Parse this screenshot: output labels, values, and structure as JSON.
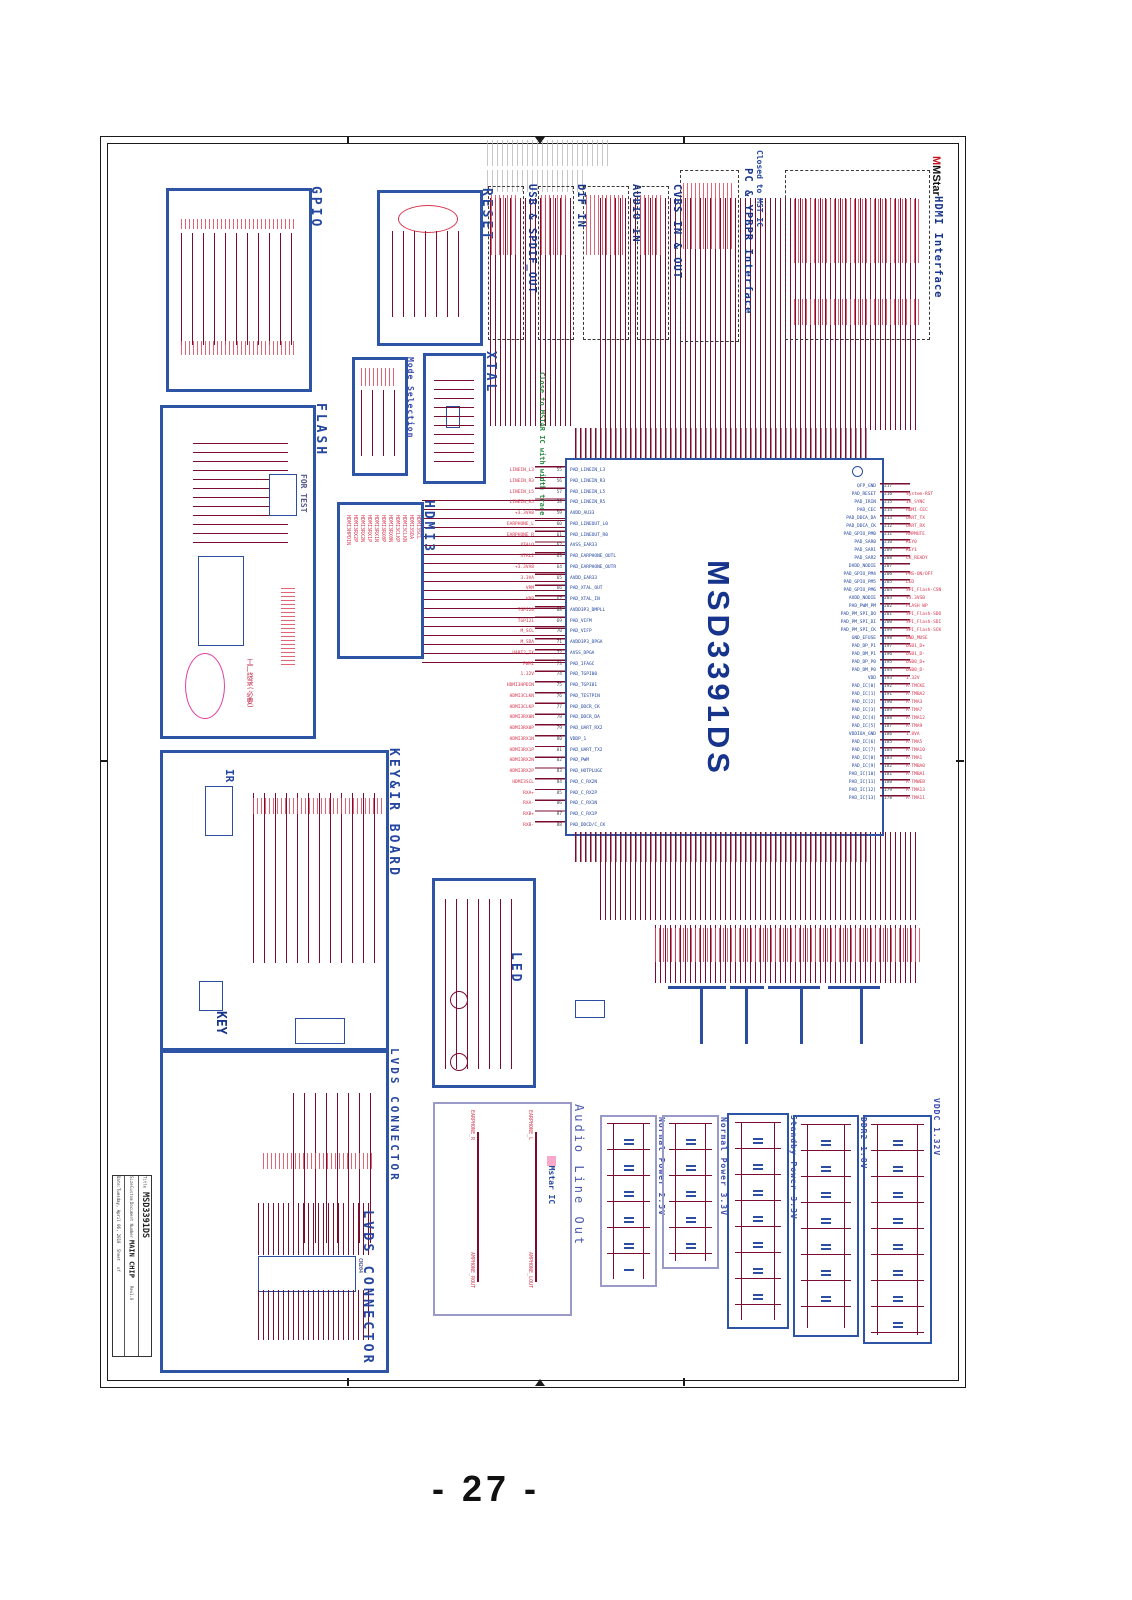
{
  "page": {
    "number": "- 27 -"
  },
  "colors": {
    "block_border": "#2e55a5",
    "soft_border": "#9a9ac8",
    "label_blue": "#2446a0",
    "wire_maroon": "#7a0c2e",
    "net_red": "#d9344e",
    "note_green": "#2e8b45",
    "highlight_magenta": "#e040a0"
  },
  "blocks": {
    "gpio": {
      "label": "GPIO"
    },
    "flash": {
      "label": "FLASH",
      "for_test": "FOR TEST",
      "factory_note": "工厂烧录(必要)"
    },
    "reset": {
      "label": "RESET"
    },
    "mode_selection": {
      "label": "Mode Selection"
    },
    "xtal": {
      "label": "XTAL",
      "note": "Close to MSTAR IC with width trace"
    },
    "hdmi3": {
      "label": "HDMI3",
      "signals": [
        "HDMI3HPDIN",
        "HDMI3RX2P",
        "HDMI3RX2N",
        "HDMI3RX1P",
        "HDMI3RX1N",
        "HDMI3RX0P",
        "HDMI3RX0N",
        "HDMI3CLKP",
        "HDMI3CLKN",
        "HDMI3SDA",
        "HDMI3SCL"
      ]
    },
    "key_ir": {
      "label": "KEY&IR BOARD",
      "ir_label": "IR",
      "key_label": "KEY"
    },
    "led": {
      "label": "LED"
    },
    "lvds": {
      "label": "LVDS  CONNECTOR",
      "inner_label": "LVDS  CONNECTOR",
      "connector": "CN204"
    },
    "audio": {
      "label": "Audio Line Out",
      "note": "Mstar IC",
      "signals": [
        "EARPHONE_R",
        "EARPHONE_L",
        "AMPHONE_ROUT",
        "AMPHONE_LOUT"
      ]
    },
    "io": {
      "usb_spdif": "USB & SPDIF_OUT",
      "dif_in": "DIF IN",
      "audio_in": "AUDIO IN",
      "cvbs": "CVBS IN & OUT",
      "ypbpr": "PC & YPBPR Interface",
      "ypbpr_note": "Closed to MST IC",
      "hdmi": "HDMI Interface",
      "logo": "MStar"
    },
    "power": [
      "Normal Power 2.5V",
      "Normal Power 3.3V",
      "Standby Power 3.3V",
      "DDR2 1.8V",
      "VDDC 1.32V"
    ]
  },
  "chip": {
    "name": "MSD3391DS",
    "left_nums": [
      "55",
      "56",
      "57",
      "58",
      "59",
      "60",
      "61",
      "62",
      "63",
      "64",
      "65",
      "66",
      "67",
      "68",
      "69",
      "70",
      "71",
      "72",
      "73",
      "74",
      "75",
      "76",
      "77",
      "78",
      "79",
      "80",
      "81",
      "82",
      "83",
      "84",
      "85",
      "86",
      "87",
      "88"
    ],
    "left_pads": [
      "PAD_LINEIN_L3",
      "PAD_LINEIN_R3",
      "PAD_LINEIN_L5",
      "PAD_LINEIN_R5",
      "AVDD_AU33",
      "PAD_LINEOUT_L0",
      "PAD_LINEOUT_R0",
      "AVSS_EAR33",
      "PAD_EARPHONE_OUTL",
      "PAD_EARPHONE_OUTR",
      "AVDD_EAR33",
      "PAD_XTAL_OUT",
      "PAD_XTAL_IN",
      "AVDD3P3_DMPLL",
      "PAD_VIFM",
      "PAD_VIFP",
      "AVDD3P3_DPGA",
      "AVSS_DPGA",
      "PAD_IFAGC",
      "PAD_TGPI00",
      "PAD_TGPI01",
      "PAD_TESTPIN",
      "PAD_DDCR_CK",
      "PAD_DDCR_DA",
      "PAD_UART_RX2",
      "VDDP_1",
      "PAD_UART_TX2",
      "PAD_PWM",
      "PAD_HOTPLUGC",
      "PAD_C_RX2N",
      "PAD_C_RX2P",
      "PAD_C_RX1N",
      "PAD_C_RX1P",
      "PAD_DDCD/C_CK"
    ],
    "left_nets": [
      "LINEIN_L3",
      "LINEIN_R3",
      "LINEIN_L5",
      "LINEIN_R5",
      "+3.3VA8",
      "EARPHONE_L",
      "EARPHONE_R",
      "XTALO",
      "XTALI",
      "+3.3VA8",
      "3.3VA",
      "VRM",
      "VRP",
      "TGPI20",
      "TGPI21",
      "M_SCL",
      "M_SDA",
      "UART2_TX",
      "PWM1",
      "1.32V",
      "HDMI3HPDIN",
      "HDMI3CLKN",
      "HDMI3CLKP",
      "HDMI3RX0N",
      "HDMI3RX0P",
      "HDMI3RX1N",
      "HDMI3RX1P",
      "HDMI3RX2N",
      "HDMI3RX2P",
      "HDMI3SCL",
      "RXA+",
      "RXA-",
      "RXB+",
      "RXB-"
    ],
    "right_nums": [
      "217",
      "216",
      "215",
      "214",
      "213",
      "212",
      "211",
      "210",
      "209",
      "208",
      "207",
      "206",
      "205",
      "204",
      "203",
      "202",
      "201",
      "200",
      "199",
      "198",
      "197",
      "196",
      "195",
      "194",
      "193",
      "192",
      "191",
      "190",
      "189",
      "188",
      "187",
      "186",
      "185",
      "184",
      "183",
      "182",
      "181",
      "180",
      "179",
      "178"
    ],
    "right_pads": [
      "QFP_GND",
      "PAD_RESET",
      "PAD_IRIN",
      "PAD_CEC",
      "PAD_DDCA_DA",
      "PAD_DDCA_CK",
      "PAD_GPIO_PM0",
      "PAD_SAR0",
      "PAD_SAR1",
      "PAD_SAR2",
      "DVDD_NODIE",
      "PAD_GPIO_PM4",
      "PAD_GPIO_PM5",
      "PAD_GPIO_PM6",
      "AVDD_NODIE",
      "PAD_PWM_PM",
      "PAD_PM_SPI_DO",
      "PAD_PM_SPI_DI",
      "PAD_PM_SPI_CK",
      "GND_EFUSE",
      "PAD_DP_P1",
      "PAD_DM_P1",
      "PAD_DP_P0",
      "PAD_DM_P0",
      "VDD",
      "PAD_IC[0]",
      "PAD_IC[1]",
      "PAD_IC[2]",
      "PAD_IC[3]",
      "PAD_IC[4]",
      "PAD_IC[5]",
      "VDDIOA_GND",
      "PAD_IC[6]",
      "PAD_IC[7]",
      "PAD_IC[8]",
      "PAD_IC[9]",
      "PAD_IC[10]",
      "PAD_IC[11]",
      "PAD_IC[12]",
      "PAD_IC[13]"
    ],
    "right_nets": [
      "",
      "System-RST",
      "IR_SYNC",
      "HDMI-CEC",
      "UART_TX",
      "UART_RX",
      "AMPMUTE",
      "KEY0",
      "KEY1",
      "CK_READY",
      "",
      "PMS-ON/OFF",
      "LED",
      "SPI_Flash-CSN",
      "+3.3VSB",
      "FLASH WP",
      "SPI_Flash-SDO",
      "SPI_Flash-SDI",
      "SPI_Flash-SCK",
      "GND_MUSE",
      "USB1_D+",
      "USB1_D-",
      "USB0_D+",
      "USB0_D-",
      "1.32V",
      "A-TMCKE",
      "A-TMBA2",
      "A-TMA3",
      "A-TMA7",
      "A-TMA12",
      "A-TMA9",
      "1.8VA",
      "A-TMA5",
      "A-TMA10",
      "A-TMA1",
      "A-TMBA0",
      "A-TMBA1",
      "A-TMWEB",
      "A-TMA13",
      "A-TMA11"
    ]
  },
  "title_block": {
    "title_label": "Title",
    "title": "MSD3391DS",
    "size_label": "Size",
    "size": "Custom",
    "doc_label": "Document Number",
    "doc": "MAIN CHIP",
    "rev_label": "Rev",
    "rev": "1.0",
    "date_label": "Date:",
    "date": "Tuesday, April 06, 2010",
    "sheet_label": "Sheet",
    "of_label": "of"
  }
}
